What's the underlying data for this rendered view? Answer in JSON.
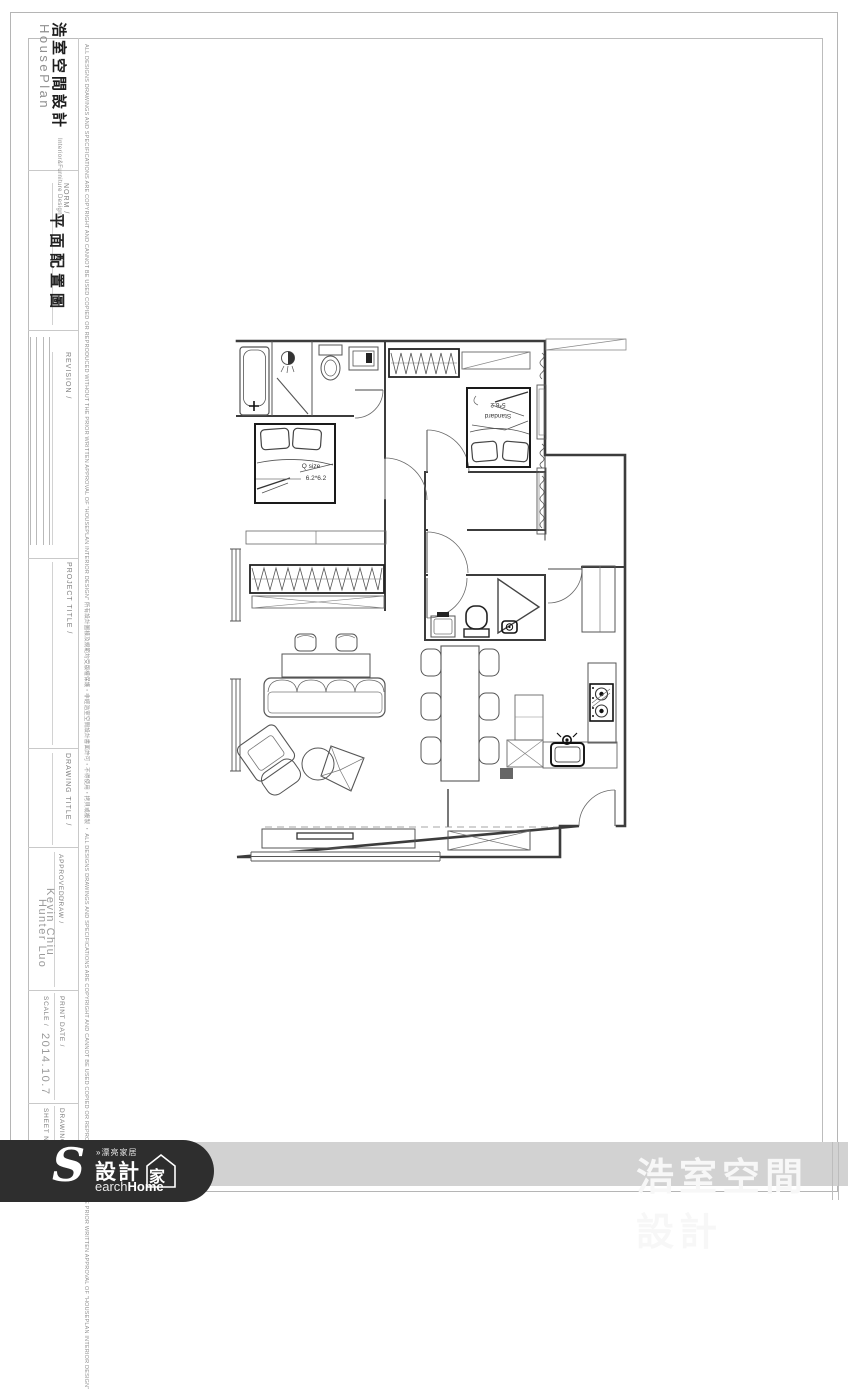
{
  "sheet": {
    "brand": {
      "cn": "浩室空間設計",
      "en": "HousePlan",
      "sub": "Interior&Furniture Design"
    },
    "titleblock": {
      "norm_label": "NORM /",
      "norm_value": "平面配置圖",
      "revision_label": "REVISION /",
      "project_title_label": "PROJECT TITLE /",
      "drawing_title_label": "DRAWING TITLE /",
      "approved_label": "APPROVED /",
      "approved_value": "Kevin Chiu",
      "draw_label": "DRAW /",
      "draw_value": "Hunter Luo",
      "print_date_label": "PRINT DATE /",
      "scale_label": "SCALE /",
      "print_date_value": "2014.10.7",
      "drawing_no_label": "DRAWING NO /",
      "sheet_no_label": "SHEET NO /"
    },
    "disclaimer": "ALL DESIGNS DRAWINGS AND SPECIFICATIONS ARE COPYRIGHT AND CANNOT BE USED COPIED OR REPRODUCED WITHOUT THE PRIOR WRITTEN APPROVAL OF \"HOUSEPLAN INTERIOR DESIGN\"  所有設計圖樣及規範均受版權保護・非經浩室空間設計書面許可・不得使用・拷貝或複製 ・ ALL DESIGNS DRAWINGS AND SPECIFICATIONS ARE COPYRIGHT AND CANNOT BE USED COPIED OR REPRODUCED WITHOUT THE PRIOR WRITTEN APPROVAL OF \"HOUSEPLAN INTERIOR DESIGN\""
  },
  "plan": {
    "master_bed_line1": "Q size",
    "master_bed_line2": "6.2*6.2",
    "bed2_line1": "5*6.2",
    "bed2_line2": "Standard"
  },
  "footer": {
    "brand_right": "浩室空間設計",
    "logo_s": "S",
    "logo_top": "»漂亮家居",
    "logo_main": "設計",
    "logo_home_char": "家",
    "logo_bottom_light": "earch",
    "logo_bottom_bold": "Home",
    "bar_color": "#d2d2d2",
    "capsule_color": "#2e2e2e"
  }
}
